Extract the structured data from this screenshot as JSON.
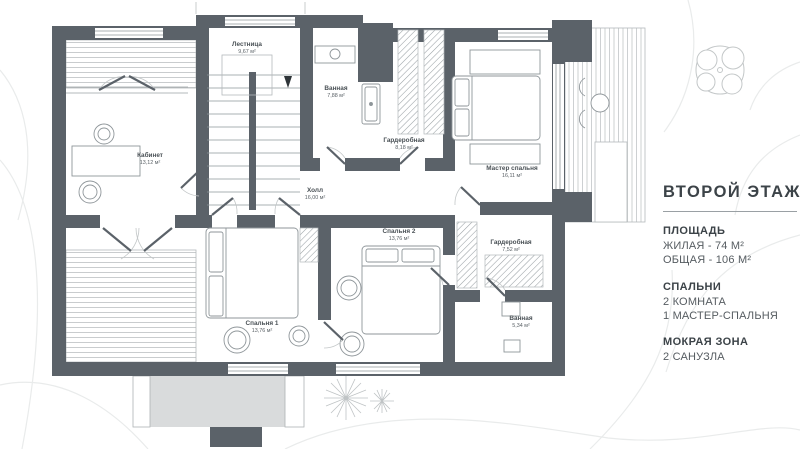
{
  "panel": {
    "title": "ВТОРОЙ ЭТАЖ",
    "sections": [
      {
        "heading": "ПЛОЩАДЬ",
        "lines": [
          "ЖИЛАЯ - 74 М²",
          "ОБЩАЯ - 106 М²"
        ]
      },
      {
        "heading": "СПАЛЬНИ",
        "lines": [
          "2 КОМНАТА",
          "1 МАСТЕР-СПАЛЬНЯ"
        ]
      },
      {
        "heading": "МОКРАЯ ЗОНА",
        "lines": [
          "2 САНУЗЛА"
        ]
      }
    ]
  },
  "rooms": [
    {
      "name": "Лестница",
      "area": "9,67 м²"
    },
    {
      "name": "Кабинет",
      "area": "13,12 м²"
    },
    {
      "name": "Ванная",
      "area": "7,88 м²"
    },
    {
      "name": "Гардеробная",
      "area": "8,18 м²"
    },
    {
      "name": "Мастер спальня",
      "area": "16,11 м²"
    },
    {
      "name": "Холл",
      "area": "16,00 м²"
    },
    {
      "name": "Спальня 1",
      "area": "13,76 м²"
    },
    {
      "name": "Спальня 2",
      "area": "13,76 м²"
    },
    {
      "name": "Гардеробная",
      "area": "7,52 м²"
    },
    {
      "name": "Ванная",
      "area": "5,34 м²"
    }
  ],
  "colors": {
    "wall": "#5b6269",
    "canopy": "#d9dbdc",
    "furniture_line": "#8f969a",
    "stripe": "#c9ccce",
    "contour": "#e9ebeb",
    "label_text": "#4a5156"
  }
}
